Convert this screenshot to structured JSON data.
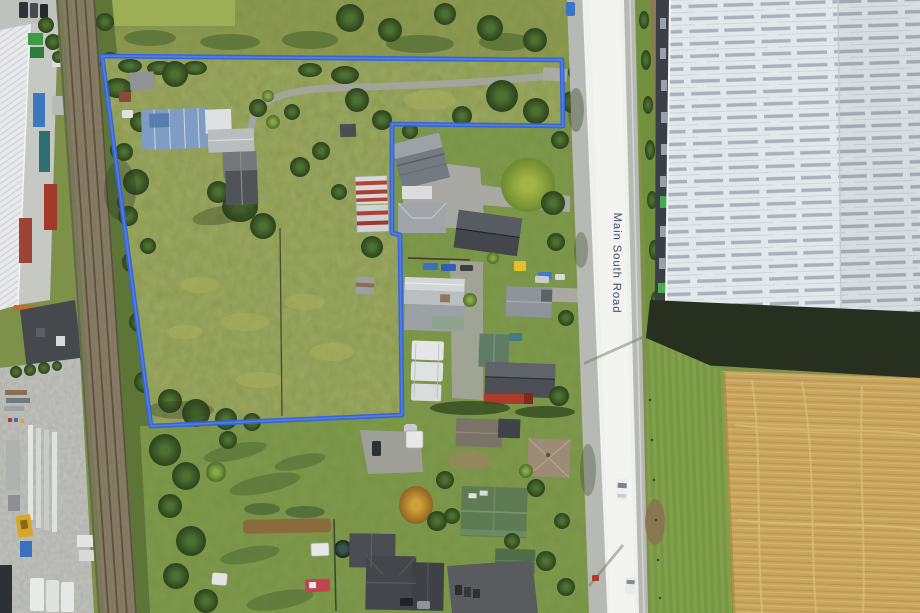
{
  "road": {
    "label": "Main South Road",
    "label_color": "#3b4866"
  },
  "boundary": {
    "color": "#3465db",
    "highlight": "#6e93ea"
  },
  "colors": {
    "parcel_grass": "#94a159",
    "scrub_grass": "#8e9c52",
    "lawn_green": "#7d9a4c",
    "stubble_field": "#c9a55e",
    "road_asphalt": "#b7bab4",
    "road_bright": "#eef0ea",
    "warehouse_roof": "#e3e8ed",
    "railway_ballast": "#8a7f66",
    "dark_roof": "#43474b"
  }
}
